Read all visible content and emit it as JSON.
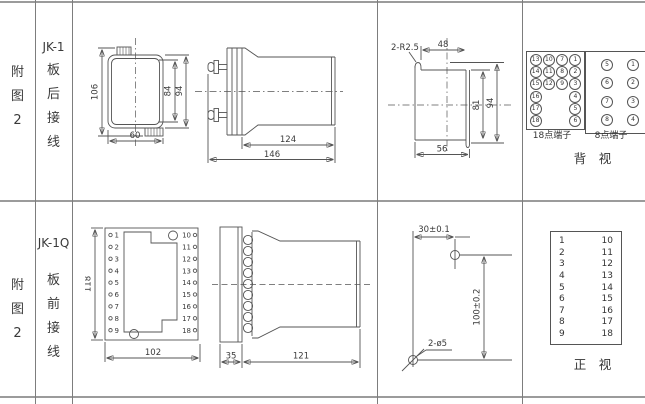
{
  "panel_labels": {
    "top_figure": [
      "附",
      "图",
      "2"
    ],
    "top_model": [
      "JK-1",
      "板",
      "后",
      "接",
      "线"
    ],
    "bottom_figure": [
      "附",
      "图",
      "2"
    ],
    "bottom_model": [
      "JK-1Q",
      "板",
      "前",
      "接",
      "线"
    ]
  },
  "rear_view": {
    "dim_total_height": "106",
    "dim_inner_height": "84",
    "dim_outer_height": "94",
    "dim_width": "60"
  },
  "side_view_top": {
    "dim_body_length": "124",
    "dim_total_length": "146"
  },
  "cutout_view": {
    "note_radius": "2-R2.5",
    "dim_top_width": "48",
    "dim_inner_height": "81",
    "dim_outer_height": "94",
    "dim_bottom_width": "56"
  },
  "rear_terminals": {
    "box18_label": "18点端子",
    "box18_rows": [
      [
        "13",
        "10",
        "7",
        "1"
      ],
      [
        "14",
        "11",
        "8",
        "2"
      ],
      [
        "15",
        "12",
        "9",
        "3"
      ],
      [
        "16",
        "",
        "",
        "4"
      ],
      [
        "17",
        "",
        "",
        "5"
      ],
      [
        "18",
        "",
        "",
        "6"
      ]
    ],
    "box8_label": "8点端子",
    "box8_rows": [
      [
        "5",
        "1"
      ],
      [
        "6",
        "2"
      ],
      [
        "7",
        "3"
      ],
      [
        "8",
        "4"
      ]
    ],
    "view_label": "背　视"
  },
  "front_view": {
    "left_terminals": [
      "1",
      "2",
      "3",
      "4",
      "5",
      "6",
      "7",
      "8",
      "9"
    ],
    "right_terminals": [
      "10",
      "11",
      "12",
      "13",
      "14",
      "15",
      "16",
      "17",
      "18"
    ],
    "dim_height": "118",
    "dim_width": "102"
  },
  "side_view_bottom": {
    "dim_plate": "35",
    "dim_body": "121"
  },
  "drilling_view": {
    "dim_horizontal": "30±0.1",
    "dim_vertical": "100±0.2",
    "note_holes": "2-ø5"
  },
  "front_table": {
    "rows": [
      [
        "1",
        "10"
      ],
      [
        "2",
        "11"
      ],
      [
        "3",
        "12"
      ],
      [
        "4",
        "13"
      ],
      [
        "5",
        "14"
      ],
      [
        "6",
        "15"
      ],
      [
        "7",
        "16"
      ],
      [
        "8",
        "17"
      ],
      [
        "9",
        "18"
      ]
    ],
    "view_label": "正　视"
  }
}
